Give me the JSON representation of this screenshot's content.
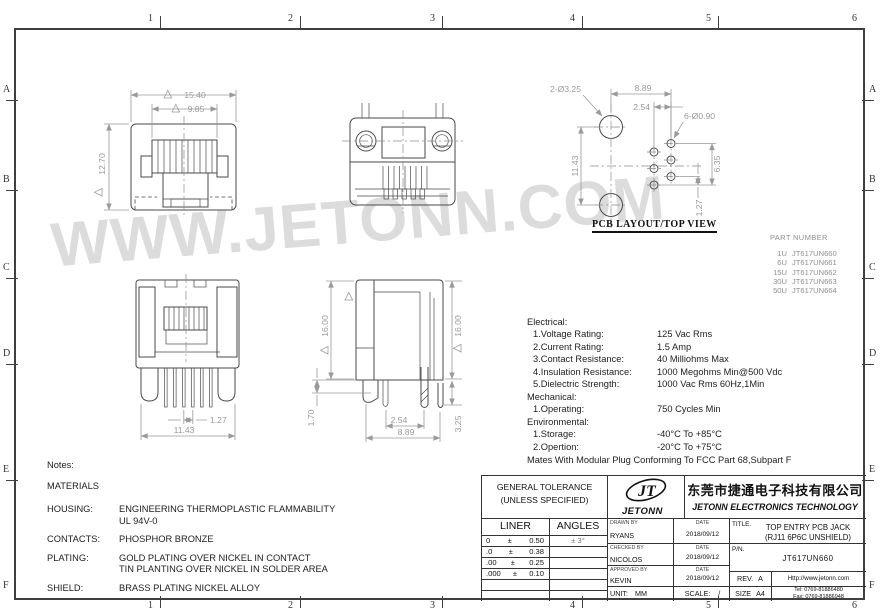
{
  "colors": {
    "line": "#4a4a4a",
    "dimension": "#9a9a9a",
    "watermark": "#dcdcdc",
    "frame": "#3f3f3f"
  },
  "watermark": "WWW.JETONN.COM",
  "frame": {
    "cols": [
      "1",
      "2",
      "3",
      "4",
      "5",
      "6"
    ],
    "rows": [
      "A",
      "B",
      "C",
      "D",
      "E",
      "F"
    ]
  },
  "pcb_label": "PCB LAYOUT/TOP VIEW",
  "dims": {
    "front_width": "15.40",
    "front_inner": "9.85",
    "front_height": "12.70",
    "rear_pitch": "1.27",
    "rear_span": "11.43",
    "side_h_left": "16.00",
    "side_h_right": "16.00",
    "side_standoff": "1.70",
    "side_off": "2.54",
    "side_span": "8.89",
    "side_pin": "3.25",
    "pcb_posts": "2-Ø3.25",
    "pcb_span": "8.89",
    "pcb_off": "2.54",
    "pcb_pins": "6-Ø0.90",
    "pcb_pitch_v": "11.43",
    "pcb_col": "6.35",
    "pcb_pitch": "1.27"
  },
  "part_number": {
    "header": "PART NUMBER",
    "rows": [
      [
        "1U",
        "JT617UN660"
      ],
      [
        "6U",
        "JT617UN661"
      ],
      [
        "15U",
        "JT617UN662"
      ],
      [
        "30U",
        "JT617UN663"
      ],
      [
        "50U",
        "JT617UN664"
      ]
    ]
  },
  "specs": {
    "rows": [
      {
        "label": "Electrical:",
        "value": ""
      },
      {
        "label": "1.Voltage Rating:",
        "value": "125 Vac Rms"
      },
      {
        "label": "2.Current Rating:",
        "value": "1.5 Amp"
      },
      {
        "label": "3.Contact Resistance:",
        "value": "40 Milliohms Max"
      },
      {
        "label": "4.Insulation Resistance:",
        "value": "1000 Megohms Min@500 Vdc"
      },
      {
        "label": "5.Dielectric Strength:",
        "value": "1000 Vac Rms 60Hz,1Min"
      },
      {
        "label": "Mechanical:",
        "value": ""
      },
      {
        "label": "1.Operating:",
        "value": "750 Cycles Min"
      },
      {
        "label": "Environmental:",
        "value": ""
      },
      {
        "label": "1.Storage:",
        "value": "-40°C To +85°C"
      },
      {
        "label": "2.Opertion:",
        "value": "-20°C To +75°C"
      }
    ],
    "footer": "Mates With Modular Plug Conforming To FCC Part 68,Subpart F"
  },
  "notes": {
    "title": "Notes:",
    "materials": "MATERIALS",
    "rows": [
      {
        "label": "HOUSING:",
        "line1": "ENGINEERING THERMOPLASTIC FLAMMABILITY",
        "line2": "UL 94V-0"
      },
      {
        "label": "CONTACTS:",
        "line1": "PHOSPHOR BRONZE"
      },
      {
        "label": "PLATING:",
        "line1": "GOLD PLATING OVER NICKEL IN CONTACT",
        "line2": "TIN PLANTING OVER NICKEL IN SOLDER AREA"
      },
      {
        "label": "SHIELD:",
        "line1": "BRASS PLATING NICKEL ALLOY"
      }
    ]
  },
  "title_block": {
    "tolerance": {
      "header1": "GENERAL TOLERANCE",
      "header2": "(UNLESS SPECIFIED)",
      "col1": "LINER",
      "col2": "ANGLES",
      "rows": [
        {
          "p": "0",
          "pm": "±",
          "v": "0.50",
          "a": "± 3°"
        },
        {
          "p": ".0",
          "pm": "±",
          "v": "0.38"
        },
        {
          "p": ".00",
          "pm": "±",
          "v": "0.25"
        },
        {
          "p": ".000",
          "pm": "±",
          "v": "0.10"
        }
      ]
    },
    "logo": {
      "monogram": "JT",
      "name": "JETONN"
    },
    "company": {
      "cn": "东莞市捷通电子科技有限公司",
      "en": "JETONN ELECTRONICS TECHNOLOGY"
    },
    "admin": {
      "drawn_label": "DRAWN BY",
      "drawn": "RYANS",
      "drawn_date": "2018/09/12",
      "checked_label": "CHECKED BY",
      "checked": "NICOLOS",
      "checked_date": "2018/09/12",
      "approved_label": "APPROVED BY",
      "approved": "KEVIN",
      "approved_date": "2018/09/12",
      "date_label": "DATE",
      "unit_label": "UNIT:",
      "unit": "MM",
      "scale_label": "SCALE:",
      "scale": "/"
    },
    "title": {
      "label": "TITLE.",
      "line1": "TOP ENTRY PCB JACK",
      "line2": "(RJ11 6P6C UNSHIELD)"
    },
    "pn": {
      "label": "P/N.",
      "value": "JT617UN660"
    },
    "rev": {
      "label": "REV.",
      "value": "A"
    },
    "size": {
      "label": "SIZE",
      "value": "A4"
    },
    "contact": {
      "web": "Http://www.jetonn.com",
      "tel": "Tel: 0769-81886480",
      "fax": "Fax: 0769-81886948"
    }
  }
}
